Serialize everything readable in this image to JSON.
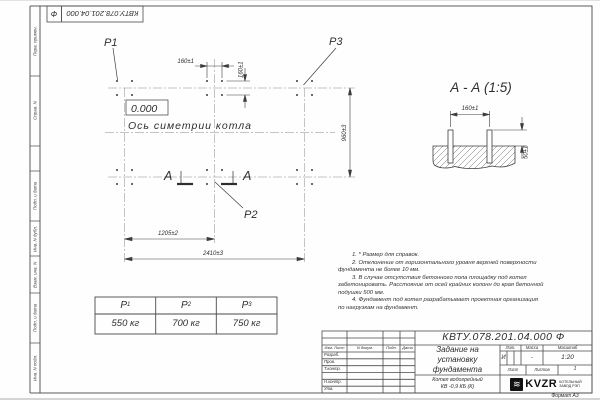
{
  "stamp": {
    "number": "КВТУ.078.201.04.000",
    "letter": "Ф"
  },
  "margin_labels": [
    "Перв. примен.",
    "Справ. N",
    "Подп. и дата",
    "Инв. N дубл.",
    "Взам. инв. N",
    "Подп. и дата",
    "Инв. N подл."
  ],
  "plan": {
    "p1": "P1",
    "p2": "P2",
    "p3": "P3",
    "level": "0.000",
    "axis_label": "Ось симетрии котла",
    "section_letter": "А",
    "dims": {
      "d160h": "160±1",
      "d160v": "160±1",
      "d960": "960±3",
      "d1205": "1205±2",
      "d2410": "2410±3"
    }
  },
  "section_view": {
    "title": "А - А (1:5)",
    "dim_160": "160±1",
    "dim_50": "50±1"
  },
  "load_table": {
    "columns": [
      {
        "name": "P",
        "sub": "1",
        "value": "550 кг"
      },
      {
        "name": "P",
        "sub": "2",
        "value": "700 кг"
      },
      {
        "name": "P",
        "sub": "3",
        "value": "750 кг"
      }
    ]
  },
  "notes": {
    "lines": [
      "1.  * Размер для справок.",
      "2.  Отклонение от горизонтального уровня верхней поверхности",
      "фундамента не более 10 мм.",
      "3.  В случае отсутствия бетонного пола площадку под котел",
      "забетонировать. Расстояние от осей крайних колонн до края бетонной",
      "подушки 500 мм.",
      "4.  Фундамент под котел разрабатывает проектная организация",
      "по нагрузкам на фундамент."
    ]
  },
  "title_block": {
    "doc_number": "КВТУ.078.201.04.000  Ф",
    "title_lines": [
      "Задание на",
      "установку",
      "фундамента"
    ],
    "product_lines": [
      "Котел водогрейный",
      "КВ -0,9  КБ  (К)"
    ],
    "header_cells": {
      "izm": "Изм. Лист",
      "ndok": "N докум.",
      "podp": "Подп.",
      "data": "Дата"
    },
    "row_labels": [
      "Разраб.",
      "Пров.",
      "Т.контр.",
      "",
      "Н.контр.",
      "Утв."
    ],
    "lit_label": "Лит.",
    "massa_label": "Масса",
    "masshtab_label": "Масштаб",
    "lit_value": "И",
    "massa_value": "-",
    "masshtab_value": "1:20",
    "list_label": "Лист",
    "listov_label": "Листов",
    "listov_value": "1",
    "logo_text": "KVZR",
    "logo_icon_glyph": "≋",
    "logo_sub_lines": [
      "КОТЕЛЬНЫЙ",
      "ЗАВОД РЭП"
    ],
    "format_label": "Формат А3"
  }
}
